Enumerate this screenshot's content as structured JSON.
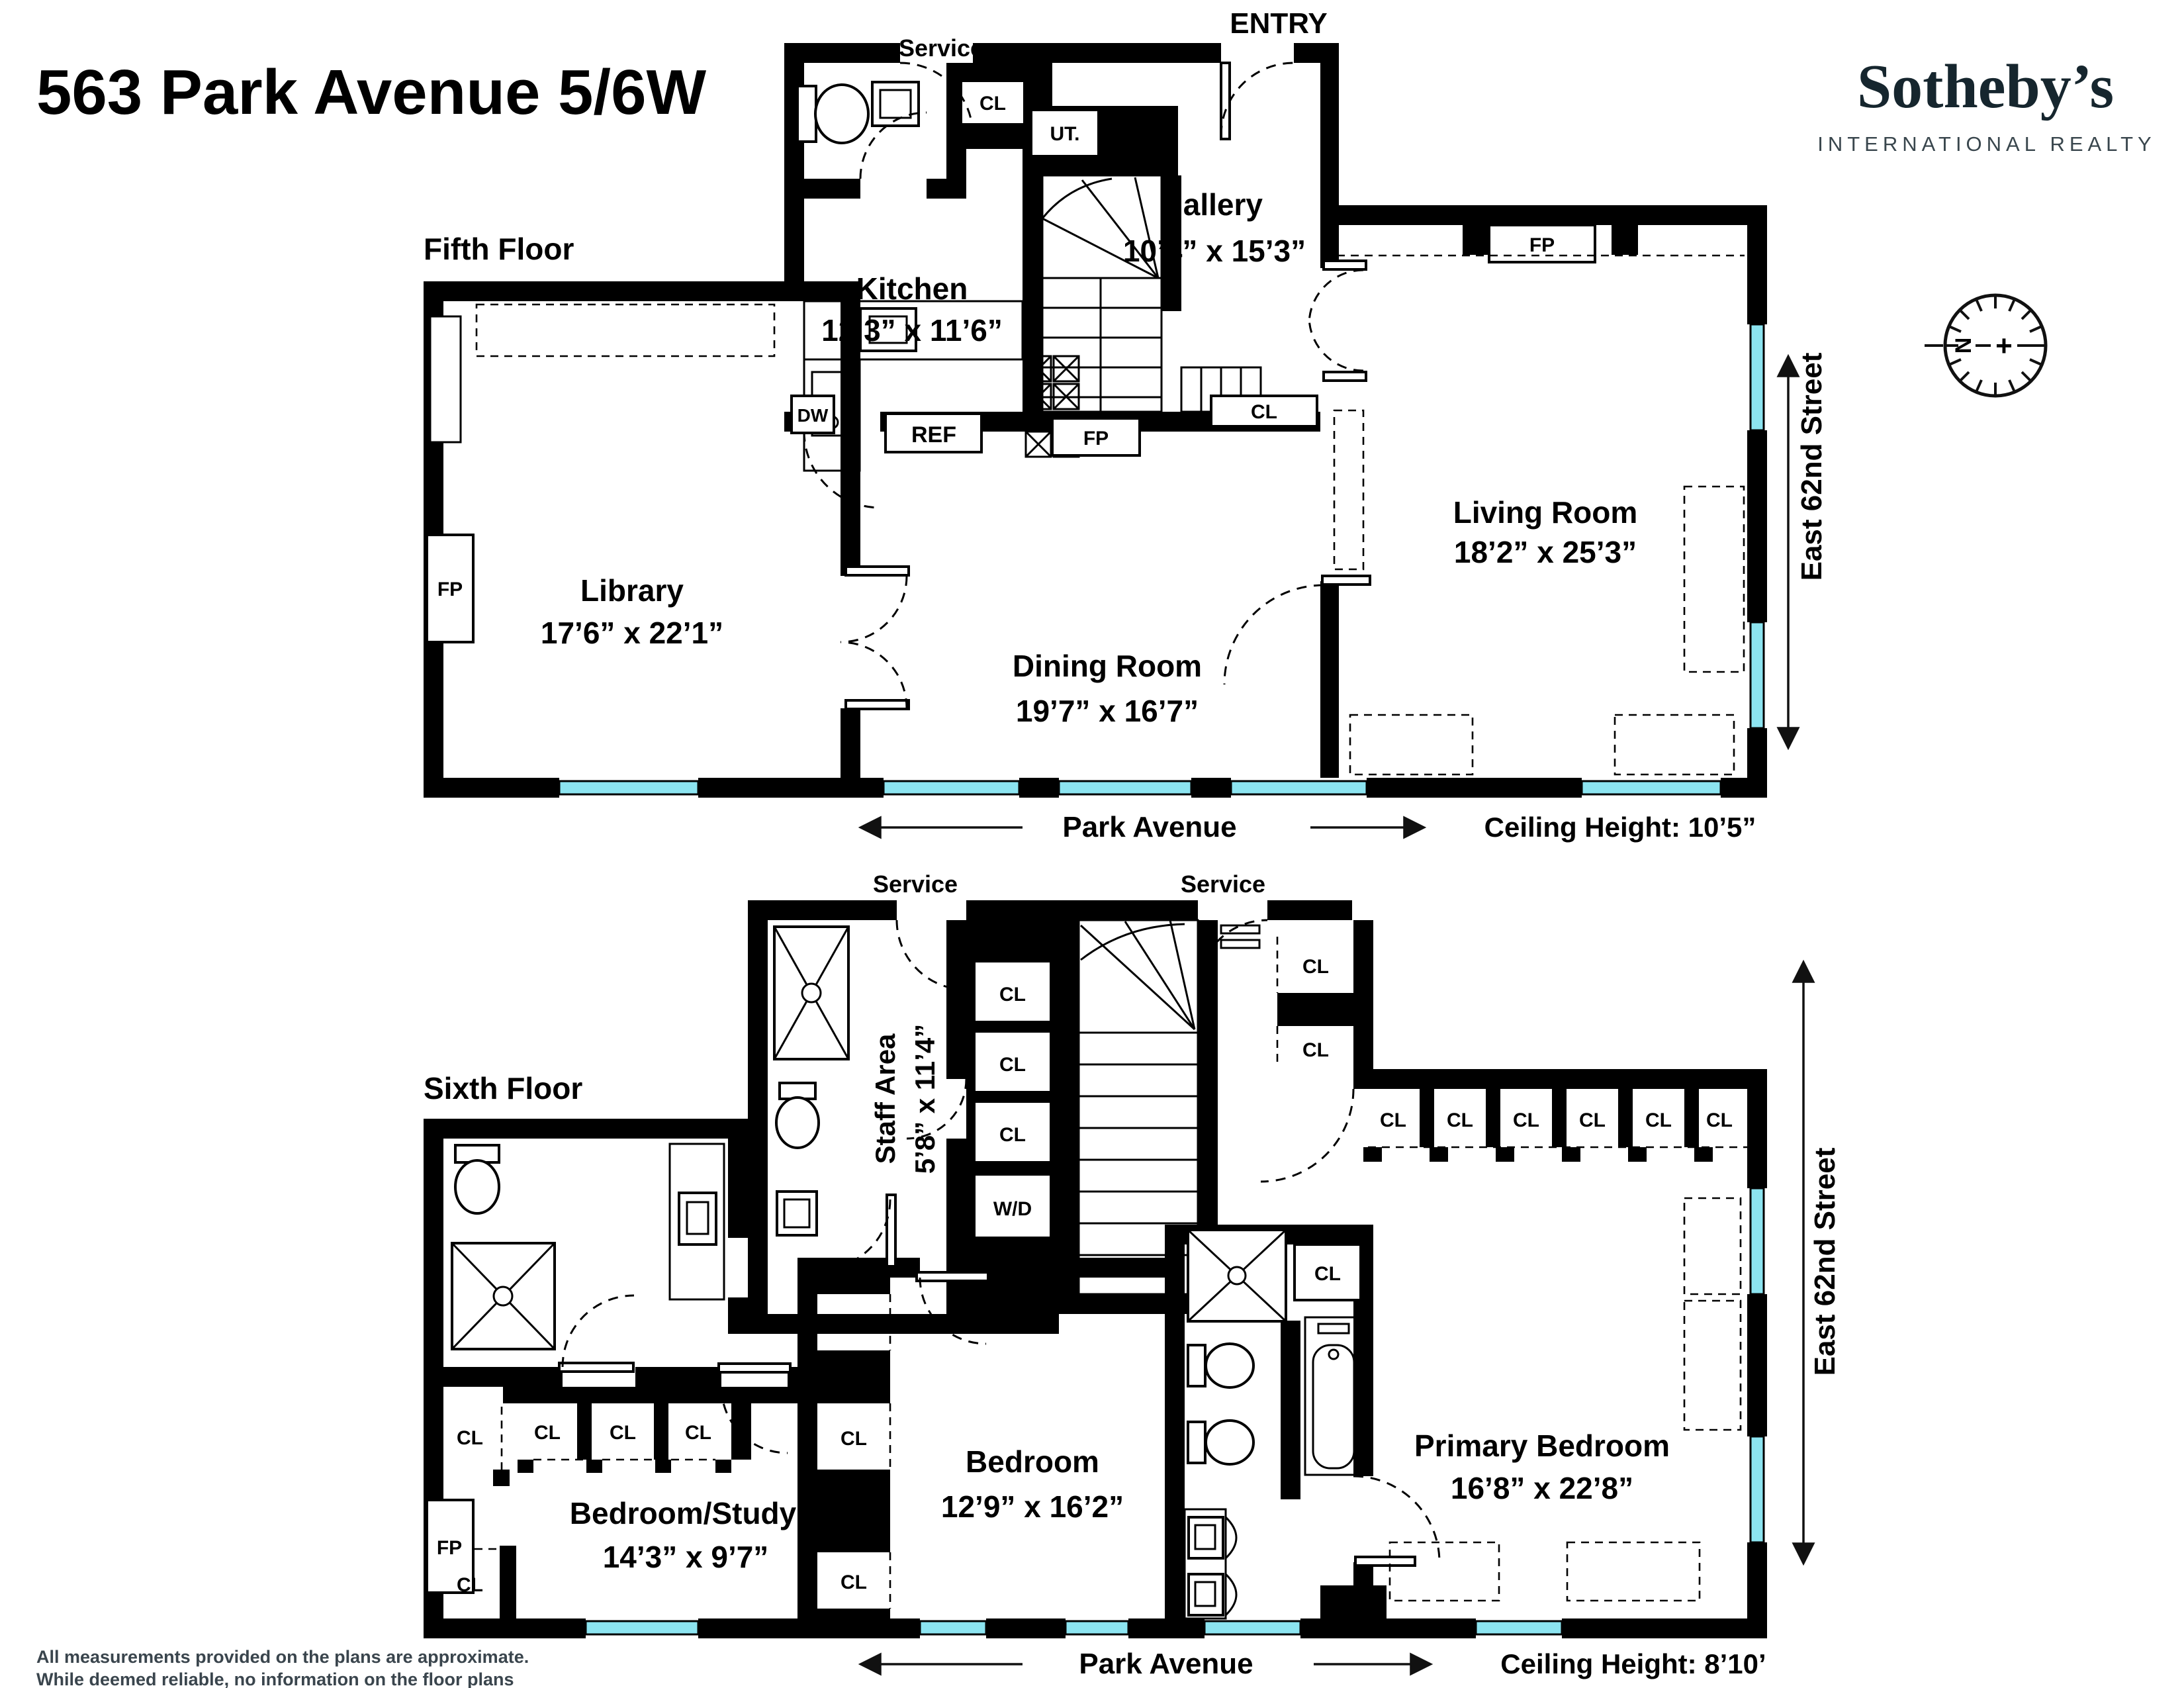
{
  "title": "563 Park Avenue 5/6W",
  "brand": {
    "wordmark": "Sotheby’s",
    "tagline": "INTERNATIONAL REALTY"
  },
  "compass": {
    "north": "N",
    "plus": "+"
  },
  "legend": {
    "service": "Service",
    "entry": "ENTRY",
    "cl": "CL",
    "ut": "UT.",
    "dw": "DW",
    "ref": "REF",
    "fp": "FP",
    "wd": "W/D"
  },
  "fifth": {
    "heading": "Fifth Floor",
    "park": "Park Avenue",
    "ceiling": "Ceiling Height: 10’5”",
    "street": "East 62nd Street",
    "rooms": {
      "gallery": {
        "name": "Gallery",
        "dims": "10’4” x 15’3”"
      },
      "kitchen": {
        "name": "Kitchen",
        "dims": "12’3” x 11’6”"
      },
      "library": {
        "name": "Library",
        "dims": "17’6” x 22’1”"
      },
      "dining": {
        "name": "Dining Room",
        "dims": "19’7” x 16’7”"
      },
      "living": {
        "name": "Living Room",
        "dims": "18’2” x 25’3”"
      }
    }
  },
  "sixth": {
    "heading": "Sixth Floor",
    "park": "Park Avenue",
    "ceiling": "Ceiling Height: 8’10’",
    "street": "East 62nd Street",
    "rooms": {
      "staff": {
        "name": "Staff Area",
        "dims": "5’8” x 11’4”"
      },
      "study": {
        "name": "Bedroom/Study",
        "dims": "14’3” x 9’7”"
      },
      "bedroom": {
        "name": "Bedroom",
        "dims": "12’9” x 16’2”"
      },
      "primary": {
        "name": "Primary Bedroom",
        "dims": "16’8” x 22’8”"
      }
    }
  },
  "disclaimer": {
    "line1": "All measurements provided on the plans are approximate.",
    "line2": "While deemed reliable, no information on the floor plans",
    "line3": "should be relied upon without independent verification."
  }
}
